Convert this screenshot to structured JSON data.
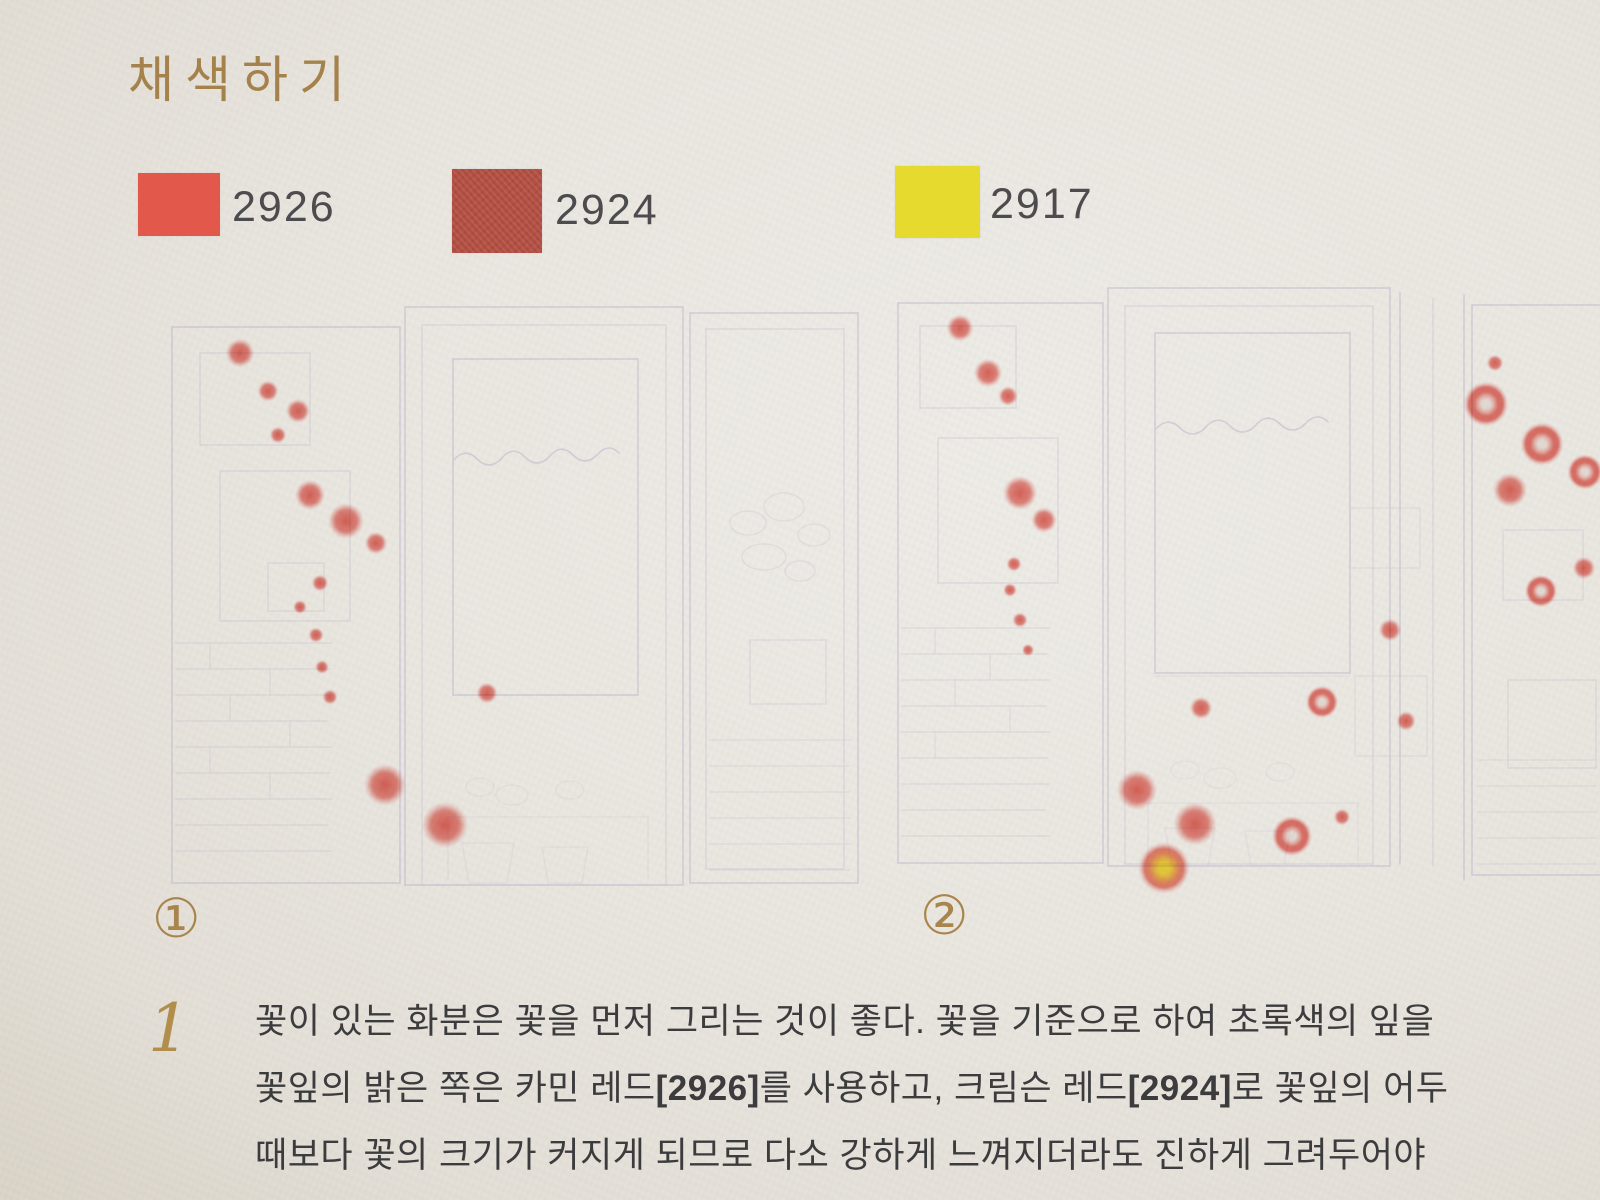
{
  "page": {
    "title": "채색하기"
  },
  "palette": [
    {
      "code": "2926",
      "color": "#e2584a",
      "name": "carmine-red"
    },
    {
      "code": "2924",
      "color": "#b24f42",
      "name": "crimson-red"
    },
    {
      "code": "2917",
      "color": "#e6da2f",
      "name": "yellow"
    }
  ],
  "instruction": {
    "number": "1",
    "lines": [
      {
        "segments": [
          {
            "t": "꽃이 있는 화분은 꽃을 먼저 그리는 것이 좋다. 꽃을 기준으로 하여 초록색의 잎을",
            "b": false
          }
        ]
      },
      {
        "segments": [
          {
            "t": "꽃잎의 밝은 쪽은 카민 레드",
            "b": false
          },
          {
            "t": "[2926]",
            "b": true
          },
          {
            "t": "를 사용하고, 크림슨 레드",
            "b": false
          },
          {
            "t": "[2924]",
            "b": true
          },
          {
            "t": "로 꽃잎의 어두",
            "b": false
          }
        ]
      },
      {
        "segments": [
          {
            "t": "때보다 꽃의 크기가 커지게 되므로 다소 강하게 느껴지더라도 진하게 그려두어야",
            "b": false
          }
        ]
      }
    ]
  },
  "illustrations": [
    {
      "badge": "①",
      "flowers": [
        {
          "x": 90,
          "y": 58,
          "s": 38,
          "v": "red"
        },
        {
          "x": 118,
          "y": 96,
          "s": 28,
          "v": "red"
        },
        {
          "x": 148,
          "y": 116,
          "s": 32,
          "v": "red"
        },
        {
          "x": 128,
          "y": 140,
          "s": 22,
          "v": "red"
        },
        {
          "x": 160,
          "y": 200,
          "s": 40,
          "v": "red"
        },
        {
          "x": 196,
          "y": 226,
          "s": 48,
          "v": "red"
        },
        {
          "x": 226,
          "y": 248,
          "s": 30,
          "v": "red"
        },
        {
          "x": 170,
          "y": 288,
          "s": 22,
          "v": "red"
        },
        {
          "x": 150,
          "y": 312,
          "s": 18,
          "v": "red"
        },
        {
          "x": 166,
          "y": 340,
          "s": 20,
          "v": "red"
        },
        {
          "x": 172,
          "y": 372,
          "s": 18,
          "v": "red"
        },
        {
          "x": 180,
          "y": 402,
          "s": 20,
          "v": "red"
        },
        {
          "x": 337,
          "y": 398,
          "s": 28,
          "v": "red"
        },
        {
          "x": 235,
          "y": 490,
          "s": 56,
          "v": "red"
        },
        {
          "x": 295,
          "y": 530,
          "s": 62,
          "v": "red"
        }
      ]
    },
    {
      "badge": "②",
      "flowers": [
        {
          "x": 80,
          "y": 50,
          "s": 36,
          "v": "red"
        },
        {
          "x": 108,
          "y": 95,
          "s": 38,
          "v": "red"
        },
        {
          "x": 128,
          "y": 118,
          "s": 26,
          "v": "red"
        },
        {
          "x": 140,
          "y": 215,
          "s": 46,
          "v": "red"
        },
        {
          "x": 164,
          "y": 242,
          "s": 34,
          "v": "red"
        },
        {
          "x": 134,
          "y": 286,
          "s": 20,
          "v": "red"
        },
        {
          "x": 130,
          "y": 312,
          "s": 18,
          "v": "red"
        },
        {
          "x": 140,
          "y": 342,
          "s": 20,
          "v": "red"
        },
        {
          "x": 148,
          "y": 372,
          "s": 16,
          "v": "red"
        },
        {
          "x": 321,
          "y": 430,
          "s": 30,
          "v": "red"
        },
        {
          "x": 442,
          "y": 424,
          "s": 42,
          "v": "white-center"
        },
        {
          "x": 257,
          "y": 512,
          "s": 54,
          "v": "red"
        },
        {
          "x": 315,
          "y": 546,
          "s": 58,
          "v": "red"
        },
        {
          "x": 412,
          "y": 558,
          "s": 52,
          "v": "white-center"
        },
        {
          "x": 284,
          "y": 590,
          "s": 66,
          "v": "yellow-center"
        },
        {
          "x": 462,
          "y": 539,
          "s": 22,
          "v": "red"
        },
        {
          "x": 510,
          "y": 352,
          "s": 30,
          "v": "red"
        },
        {
          "x": 526,
          "y": 443,
          "s": 26,
          "v": "red"
        }
      ]
    },
    {
      "badge": "",
      "flowers": [
        {
          "x": 37,
          "y": 78,
          "s": 22,
          "v": "red"
        },
        {
          "x": 28,
          "y": 119,
          "s": 58,
          "v": "white-center"
        },
        {
          "x": 84,
          "y": 159,
          "s": 56,
          "v": "white-center"
        },
        {
          "x": 127,
          "y": 187,
          "s": 46,
          "v": "white-center"
        },
        {
          "x": 52,
          "y": 205,
          "s": 46,
          "v": "red"
        },
        {
          "x": 83,
          "y": 306,
          "s": 42,
          "v": "white-center"
        },
        {
          "x": 126,
          "y": 283,
          "s": 30,
          "v": "red"
        }
      ]
    }
  ],
  "colors": {
    "paper": "#e9e6e1",
    "accent_gold": "#a8854b",
    "body_text": "#3c3c3e",
    "sketch_lavender": "#b3a6c6",
    "flower_red": "#e1524a",
    "flower_yellow": "#f5d628"
  }
}
